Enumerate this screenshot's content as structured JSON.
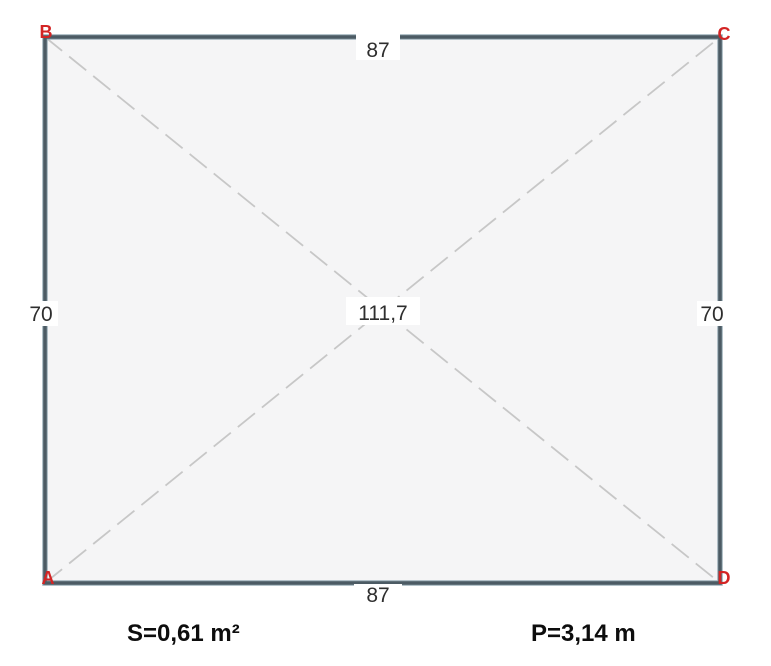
{
  "figure": {
    "vertices": {
      "top_left": "B",
      "top_right": "C",
      "bottom_left": "A",
      "bottom_right": "D"
    },
    "dimensions": {
      "top": "87",
      "bottom": "87",
      "left": "70",
      "right": "70",
      "diagonal": "111,7"
    },
    "summary": {
      "area": "S=0,61 m²",
      "perimeter": "P=3,14 m"
    },
    "colors": {
      "wall": "#4c5b64",
      "wall_edge": "#9bafb8",
      "vertex_label": "#d32424",
      "dimension_text": "#2e2e2e",
      "diagonal_line": "#c7c7c7",
      "interior": "#f5f5f6",
      "background": "#ffffff"
    }
  }
}
